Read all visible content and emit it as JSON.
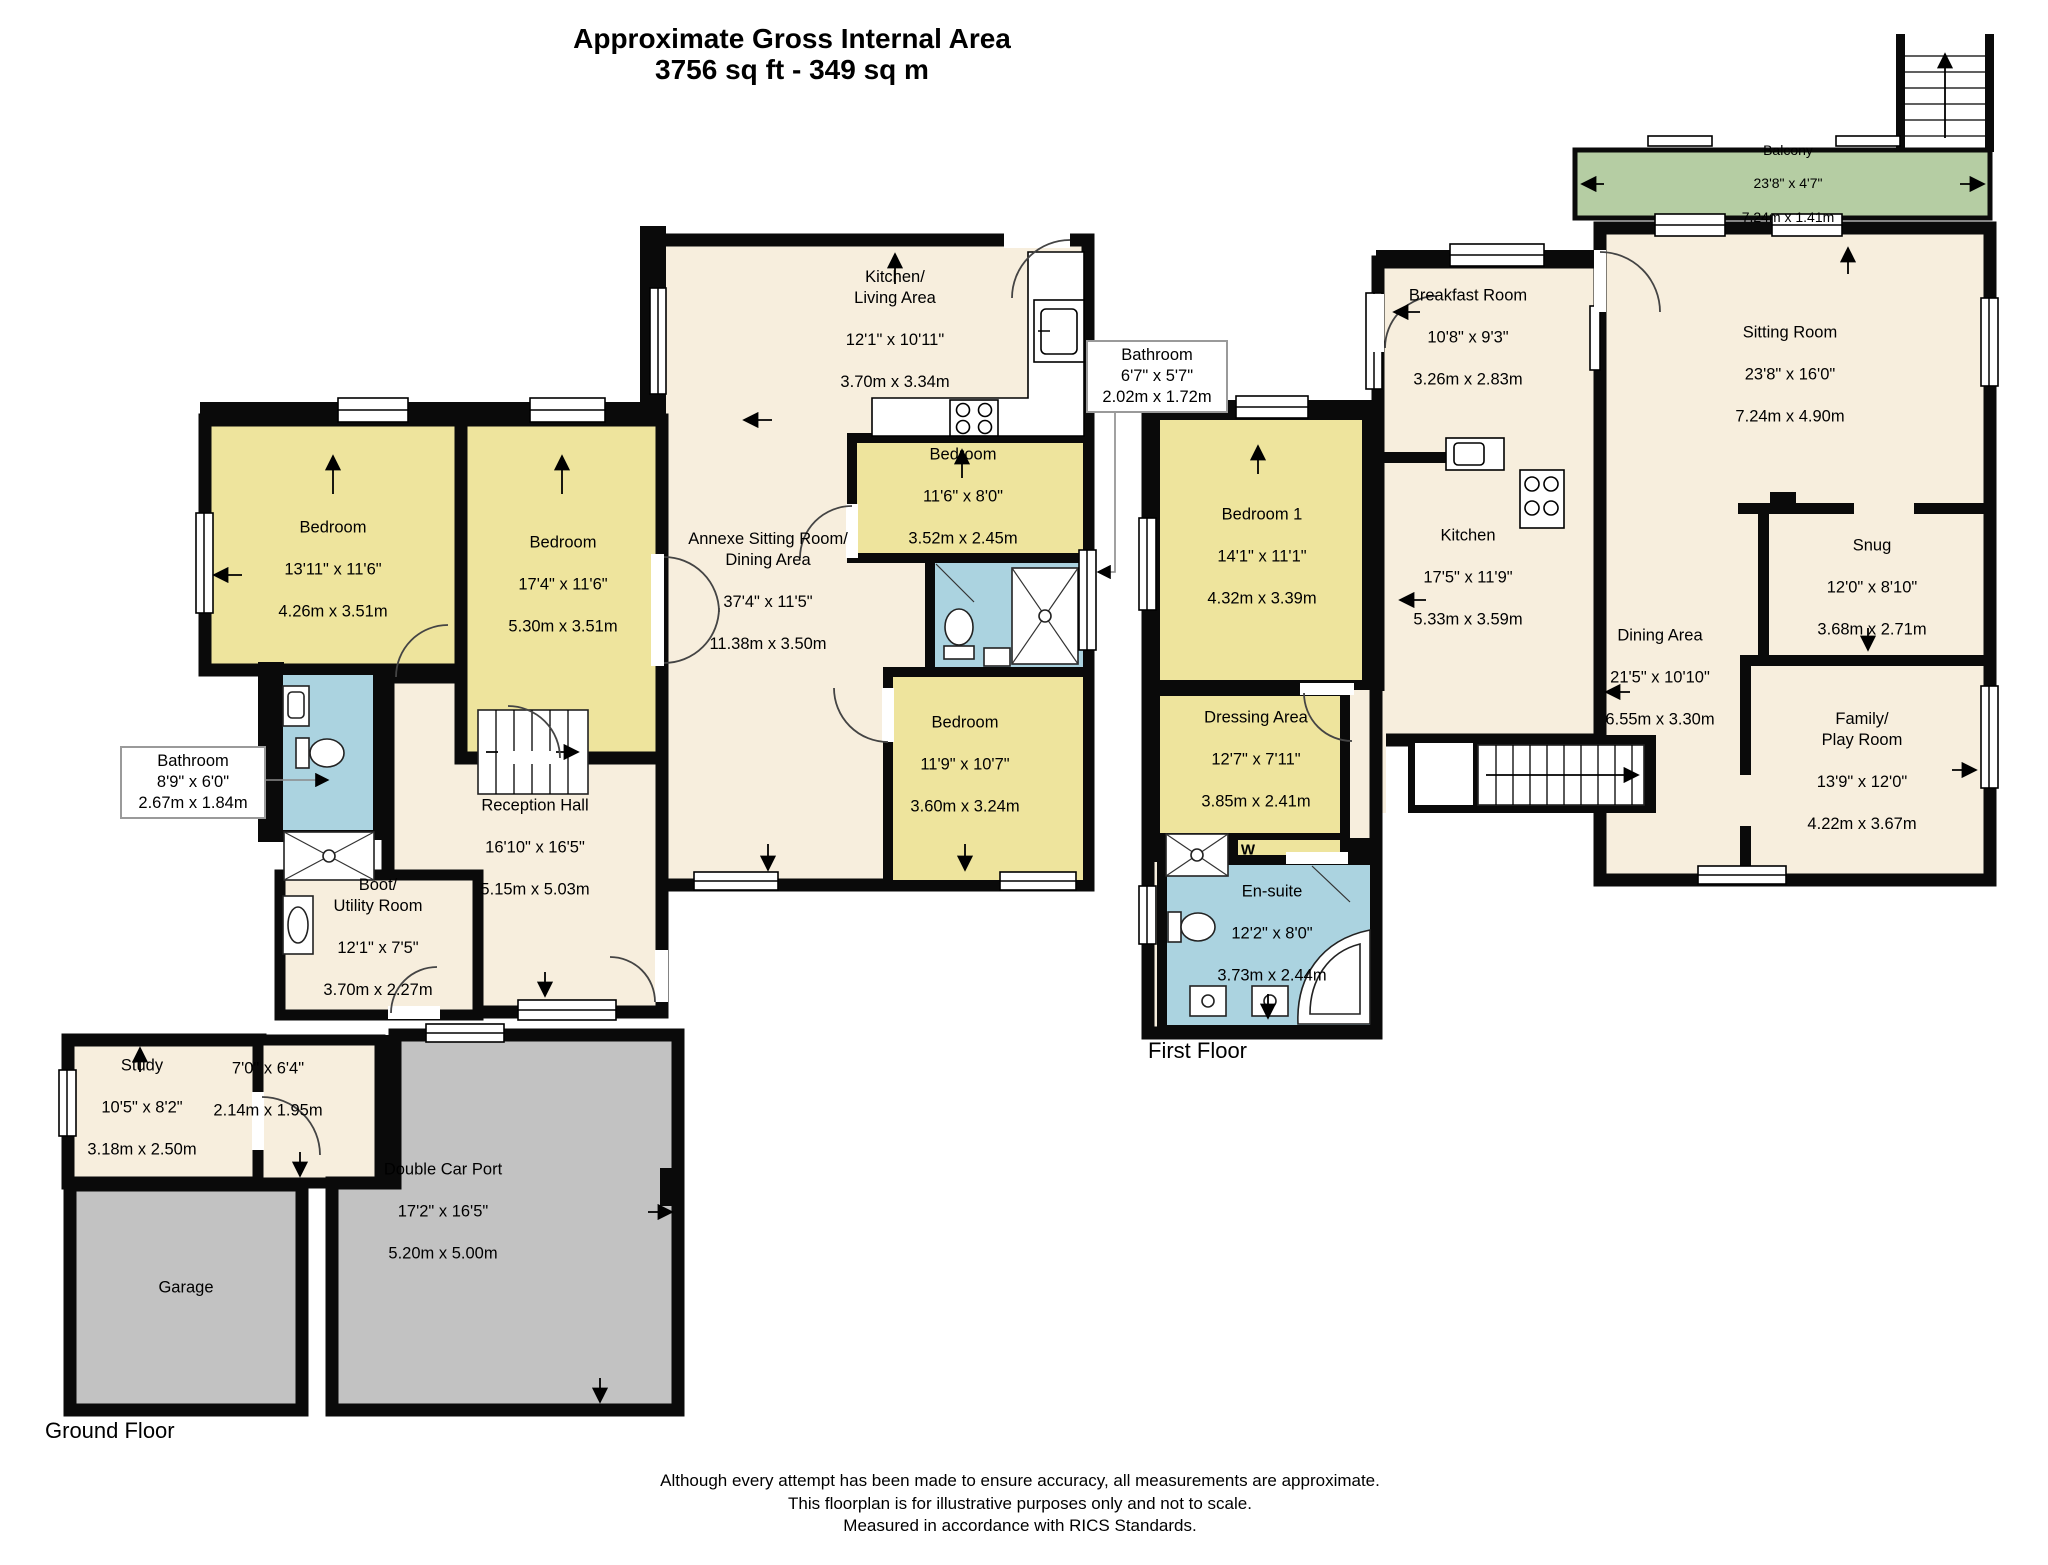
{
  "title": {
    "line1": "Approximate Gross Internal Area",
    "line2": "3756 sq ft - 349 sq m"
  },
  "ground_floor": {
    "label": "Ground Floor",
    "rooms": [
      {
        "name": "Bedroom",
        "imperial": "13'11\" x 11'6\"",
        "metric": "4.26m x 3.51m"
      },
      {
        "name": "Bedroom",
        "imperial": "17'4\" x 11'6\"",
        "metric": "5.30m x 3.51m"
      },
      {
        "name": "Kitchen/\nLiving Area",
        "imperial": "12'1\" x 10'11\"",
        "metric": "3.70m x 3.34m"
      },
      {
        "name": "Bedroom",
        "imperial": "11'6\" x 8'0\"",
        "metric": "3.52m x 2.45m"
      },
      {
        "name": "Annexe Sitting Room/\nDining Area",
        "imperial": "37'4\" x 11'5\"",
        "metric": "11.38m x 3.50m"
      },
      {
        "name": "Bedroom",
        "imperial": "11'9\" x 10'7\"",
        "metric": "3.60m x 3.24m"
      },
      {
        "name": "Reception Hall",
        "imperial": "16'10\" x 16'5\"",
        "metric": "5.15m x 5.03m"
      },
      {
        "name": "Boot/\nUtility Room",
        "imperial": "12'1\" x 7'5\"",
        "metric": "3.70m x 2.27m"
      },
      {
        "name": "Study",
        "imperial": "10'5\" x 8'2\"",
        "metric": "3.18m x 2.50m"
      },
      {
        "name": "",
        "imperial": "7'0\" x 6'4\"",
        "metric": "2.14m x 1.95m"
      },
      {
        "name": "Garage",
        "imperial": "",
        "metric": ""
      },
      {
        "name": "Double Car Port",
        "imperial": "17'2\" x 16'5\"",
        "metric": "5.20m x 5.00m"
      }
    ],
    "callouts": [
      {
        "name": "Bathroom",
        "imperial": "6'7\" x 5'7\"",
        "metric": "2.02m x 1.72m"
      },
      {
        "name": "Bathroom",
        "imperial": "8'9\" x 6'0\"",
        "metric": "2.67m x 1.84m"
      }
    ]
  },
  "first_floor": {
    "label": "First Floor",
    "rooms": [
      {
        "name": "Balcony",
        "imperial": "23'8\" x 4'7\"",
        "metric": "7.24m x 1.41m"
      },
      {
        "name": "Breakfast Room",
        "imperial": "10'8\" x 9'3\"",
        "metric": "3.26m x 2.83m"
      },
      {
        "name": "Sitting Room",
        "imperial": "23'8\" x 16'0\"",
        "metric": "7.24m x 4.90m"
      },
      {
        "name": "Bedroom 1",
        "imperial": "14'1\" x 11'1\"",
        "metric": "4.32m x 3.39m"
      },
      {
        "name": "Kitchen",
        "imperial": "17'5\" x 11'9\"",
        "metric": "5.33m x 3.59m"
      },
      {
        "name": "Snug",
        "imperial": "12'0\" x 8'10\"",
        "metric": "3.68m x 2.71m"
      },
      {
        "name": "Dining Area",
        "imperial": "21'5\" x 10'10\"",
        "metric": "6.55m x 3.30m"
      },
      {
        "name": "Dressing Area",
        "imperial": "12'7\" x 7'11\"",
        "metric": "3.85m x 2.41m"
      },
      {
        "name": "Family/\nPlay Room",
        "imperial": "13'9\" x 12'0\"",
        "metric": "4.22m x 3.67m"
      },
      {
        "name": "En-suite",
        "imperial": "12'2\" x 8'0\"",
        "metric": "3.73m x 2.44m"
      }
    ],
    "annotations": {
      "wardrobe": "W"
    }
  },
  "footer": {
    "line1": "Although every attempt has been made to ensure accuracy, all measurements are approximate.",
    "line2": "This floorplan is for illustrative purposes only and not to scale.",
    "line3": "Measured in accordance with RICS Standards."
  },
  "colors": {
    "wall": "#0a0a0a",
    "cream": "#f7eedd",
    "yellow": "#eee49d",
    "blue": "#abd3e0",
    "green": "#b5cda3",
    "gray": "#c2c2c2"
  }
}
